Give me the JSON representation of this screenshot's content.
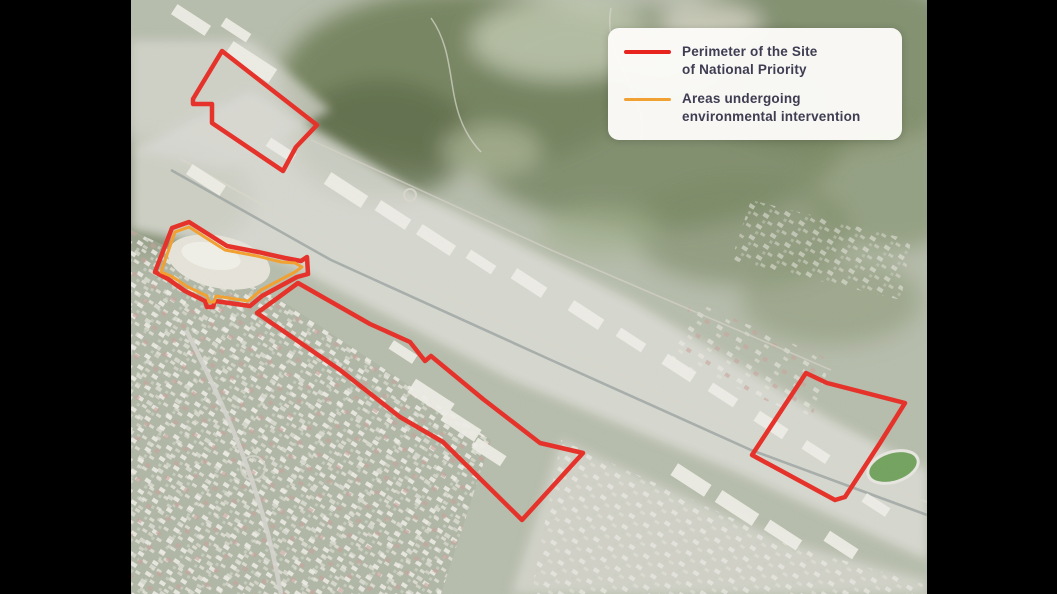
{
  "window": {
    "width": 1057,
    "height": 594,
    "background": "#000000"
  },
  "map": {
    "left": 131,
    "top": 0,
    "width": 796,
    "height": 594,
    "imagery": "satellite-aerial"
  },
  "legend": {
    "x": 477,
    "y": 28,
    "background": "#fcfbf8",
    "text_color": "#3e3d52",
    "items": [
      {
        "name": "site-perimeter",
        "swatch_color": "#e8241f",
        "lines": [
          "Perimeter of the Site",
          "of National Priority"
        ]
      },
      {
        "name": "environmental-intervention",
        "swatch_color": "#f0a132",
        "lines": [
          "Areas undergoing",
          "environmental intervention"
        ]
      }
    ]
  },
  "overlays": [
    {
      "id": "perimeter-north-sector",
      "type": "site-perimeter",
      "color": "#e5332b",
      "stroke_width": 4.5,
      "points": [
        [
          91,
          51
        ],
        [
          186,
          125
        ],
        [
          165,
          147
        ],
        [
          152,
          171
        ],
        [
          81,
          123
        ],
        [
          81,
          104
        ],
        [
          62,
          104
        ],
        [
          62,
          99
        ]
      ]
    },
    {
      "id": "perimeter-quarry-sector",
      "type": "site-perimeter",
      "color": "#e5332b",
      "stroke_width": 4.5,
      "points": [
        [
          41,
          228
        ],
        [
          58,
          222
        ],
        [
          96,
          246
        ],
        [
          127,
          252
        ],
        [
          154,
          258
        ],
        [
          170,
          261
        ],
        [
          176,
          257
        ],
        [
          177,
          274
        ],
        [
          166,
          277
        ],
        [
          131,
          296
        ],
        [
          119,
          306
        ],
        [
          84,
          301
        ],
        [
          82,
          307
        ],
        [
          76,
          307
        ],
        [
          74,
          301
        ],
        [
          54,
          291
        ],
        [
          37,
          279
        ],
        [
          24,
          272
        ]
      ]
    },
    {
      "id": "environmental-intervention-area",
      "type": "intervention-area",
      "color": "#f0a132",
      "stroke_width": 3,
      "points": [
        [
          44,
          232
        ],
        [
          58,
          227
        ],
        [
          94,
          250
        ],
        [
          126,
          256
        ],
        [
          150,
          262
        ],
        [
          164,
          263
        ],
        [
          171,
          267
        ],
        [
          164,
          272
        ],
        [
          130,
          290
        ],
        [
          117,
          301
        ],
        [
          85,
          296
        ],
        [
          83,
          302
        ],
        [
          78,
          302
        ],
        [
          76,
          296
        ],
        [
          57,
          287
        ],
        [
          40,
          276
        ],
        [
          30,
          272
        ]
      ]
    },
    {
      "id": "perimeter-central-sector",
      "type": "site-perimeter",
      "color": "#e5332b",
      "stroke_width": 4.5,
      "points": [
        [
          167,
          283
        ],
        [
          239,
          324
        ],
        [
          279,
          342
        ],
        [
          294,
          361
        ],
        [
          300,
          356
        ],
        [
          352,
          399
        ],
        [
          409,
          443
        ],
        [
          452,
          453
        ],
        [
          391,
          520
        ],
        [
          312,
          442
        ],
        [
          269,
          417
        ],
        [
          209,
          370
        ],
        [
          126,
          313
        ]
      ]
    },
    {
      "id": "perimeter-east-sector",
      "type": "site-perimeter",
      "color": "#e5332b",
      "stroke_width": 4.5,
      "points": [
        [
          675,
          373
        ],
        [
          696,
          383
        ],
        [
          774,
          403
        ],
        [
          749,
          443
        ],
        [
          714,
          497
        ],
        [
          704,
          500
        ],
        [
          621,
          455
        ]
      ]
    }
  ]
}
